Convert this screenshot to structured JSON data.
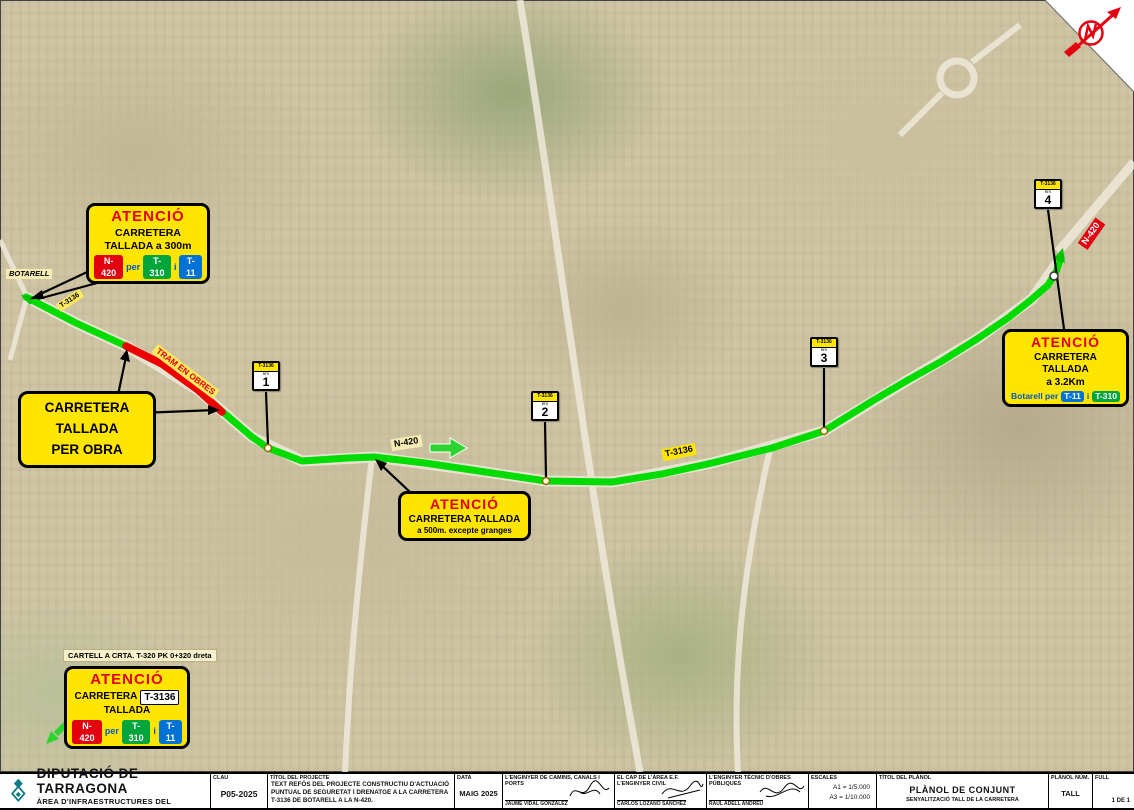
{
  "colors": {
    "sign_yellow": "#FFE500",
    "attention_red": "#E3000F",
    "badge_red": "#E3000F",
    "badge_green": "#00A63C",
    "badge_blue": "#0072D6",
    "word_blue": "#0055CC",
    "route_green": "#00DC00",
    "route_red": "#EE0000",
    "logo_teal": "#0B7C86"
  },
  "map": {
    "place_botarell": "BOTARELL",
    "label_t3136_west": "T-3136",
    "label_tram_obres": "TRAM EN OBRES",
    "label_n420_mid": "N-420",
    "label_t3136_mid": "T-3136",
    "label_n420_east": "N-420",
    "km_posts": [
      {
        "road": "T-3136",
        "unit": "km",
        "num": "1"
      },
      {
        "road": "T-3136",
        "unit": "km",
        "num": "2"
      },
      {
        "road": "T-3136",
        "unit": "km",
        "num": "3"
      },
      {
        "road": "T-3136",
        "unit": "km",
        "num": "4"
      }
    ]
  },
  "signs": {
    "west": {
      "title": "ATENCIÓ",
      "line1": "CARRETERA",
      "line2": "TALLADA a 300m",
      "badge_n420": "N-420",
      "word_per": "per",
      "badge_t310": "T-310",
      "word_i": "i",
      "badge_t11": "T-11"
    },
    "obra": {
      "line1": "CARRETERA",
      "line2": "TALLADA",
      "line3": "PER OBRA"
    },
    "mid": {
      "title": "ATENCIÓ",
      "line1": "CARRETERA TALLADA",
      "line2": "a 500m. excepte granges"
    },
    "east": {
      "title": "ATENCIÓ",
      "line1": "CARRETERA TALLADA",
      "line2": "a 3.2Km",
      "prefix": "Botarell per",
      "badge_t11": "T-11",
      "word_i": "i",
      "badge_t310": "T-310"
    },
    "south_note": "CARTELL A CRTA. T-320 PK 0+320 dreta",
    "south": {
      "title": "ATENCIÓ",
      "line1a": "CARRETERA",
      "line1b": "T-3136",
      "line2": "TALLADA",
      "badge_n420": "N-420",
      "word_per": "per",
      "badge_t310": "T-310",
      "word_i": "i",
      "badge_t11": "T-11"
    }
  },
  "titleblock": {
    "org_name": "DIPUTACIÓ DE TARRAGONA",
    "org_dept": "ÀREA D'INFRAESTRUCTURES DEL TERRITORI",
    "clau_label": "CLAU",
    "clau_value": "P05-2025",
    "project_label": "TÍTOL DEL PROJECTE",
    "project_text": "TEXT REFÓS DEL PROJECTE CONSTRUCTIU D'ACTUACIÓ PUNTUAL DE SEGURETAT I DRENATGE A LA CARRETERA T-3136 DE BOTARELL A LA N-420.",
    "date_label": "DATA",
    "date_value": "MAIG 2025",
    "eng1_label": "L'ENGINYER DE CAMINS, CANALS I PORTS",
    "eng1_name": "JAUME VIDAL GONZALEZ",
    "eng2_label": "EL CAP DE L'ÀREA E.F. L'ENGINYER CIVIL",
    "eng2_name": "CARLOS LOZANO SANCHEZ",
    "eng3_label": "L'ENGINYER TÈCNIC D'OBRES PÚBLIQUES",
    "eng3_name": "RAUL ADELL ANDREU",
    "scales_label": "ESCALES",
    "scale_a1": "A1 = 1/5.000",
    "scale_a3": "A3 = 1/10.000",
    "plan_label": "TÍTOL DEL PLÀNOL",
    "plan_title": "PLÀNOL DE CONJUNT",
    "plan_subtitle": "SENYALITZACIÓ TALL DE LA CARRETERA",
    "plan_num_label": "PLÀNOL NÚM.",
    "plan_num_value": "TALL",
    "sheet_label": "FULL",
    "sheet_value": "1 DE 1"
  }
}
